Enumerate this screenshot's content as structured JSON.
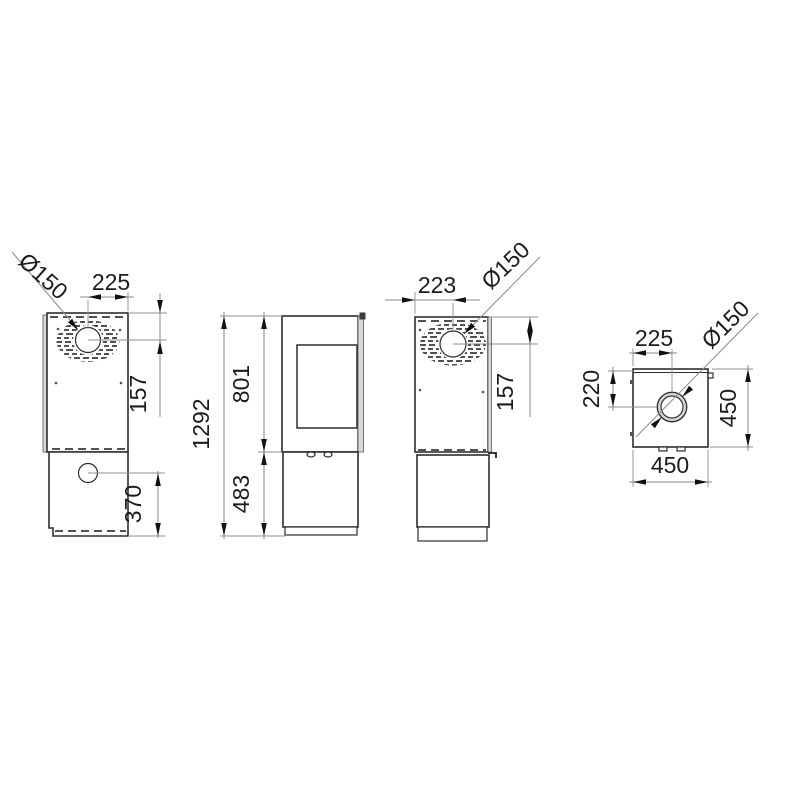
{
  "drawing_type": "stove-technical-dimension-drawing",
  "colors": {
    "background": "#ffffff",
    "body_line": "#2e2e2e",
    "dimension_line": "#8a8a8a",
    "text": "#1c1c1c",
    "panel_shade": "#d9d9d9"
  },
  "views": {
    "back_left": {
      "name": "rear view (left)",
      "label_flue_diameter": "Ø150",
      "label_flue_offset_x": "225",
      "label_flue_offset_top": "157",
      "label_lower_outlet_height": "370"
    },
    "front": {
      "name": "side view with glass door",
      "label_total_height": "1292",
      "label_body_height": "801",
      "label_base_height": "483"
    },
    "back_right": {
      "name": "rear view (right)",
      "label_flue_offset_x": "223",
      "label_flue_diameter": "Ø150",
      "label_flue_offset_top": "157"
    },
    "top": {
      "name": "top view",
      "label_flue_offset_x": "225",
      "label_flue_offset_y": "220",
      "label_flue_diameter": "Ø150",
      "label_depth": "450",
      "label_width": "450"
    }
  }
}
